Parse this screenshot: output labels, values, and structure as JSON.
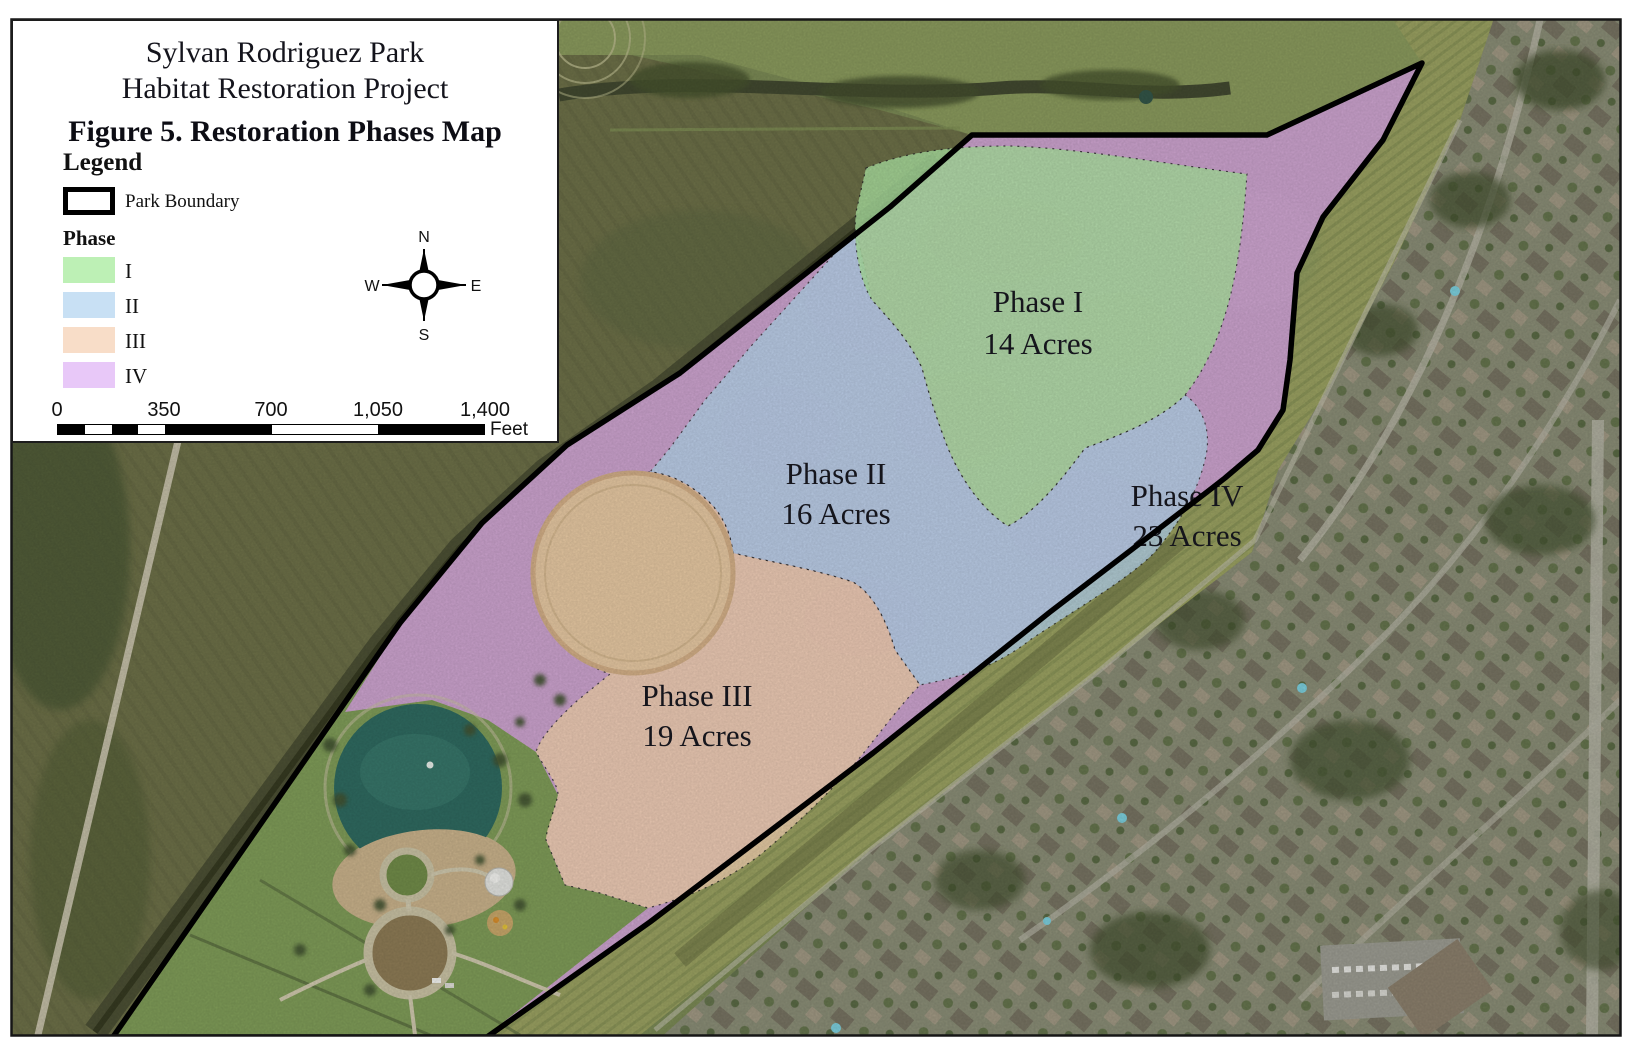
{
  "legend": {
    "title_line1": "Sylvan Rodriguez Park",
    "title_line2": "Habitat Restoration Project",
    "figure_title": "Figure 5. Restoration Phases Map",
    "heading": "Legend",
    "park_boundary_label": "Park Boundary",
    "phase_heading": "Phase",
    "phases": [
      {
        "numeral": "I",
        "color": "#bdf0b5"
      },
      {
        "numeral": "II",
        "color": "#c8e0f4"
      },
      {
        "numeral": "III",
        "color": "#f8ddc8"
      },
      {
        "numeral": "IV",
        "color": "#e8c8f8"
      }
    ]
  },
  "compass": {
    "north": "N",
    "east": "E",
    "south": "S",
    "west": "W"
  },
  "scale_bar": {
    "ticks": [
      "0",
      "350",
      "700",
      "1,050",
      "1,400"
    ],
    "unit": "Feet"
  },
  "map_labels": [
    {
      "id": "phase-1",
      "title": "Phase I",
      "acres": "14 Acres"
    },
    {
      "id": "phase-2",
      "title": "Phase II",
      "acres": "16 Acres"
    },
    {
      "id": "phase-3",
      "title": "Phase III",
      "acres": "19 Acres"
    },
    {
      "id": "phase-4",
      "title": "Phase IV",
      "acres": "23 Acres"
    }
  ],
  "map_overlay_colors": {
    "phase1": "#aee4a2",
    "phase2": "#b7d5ec",
    "phase3": "#f3d2b0",
    "phase4": "#e2abef",
    "boundary": "#000000"
  }
}
